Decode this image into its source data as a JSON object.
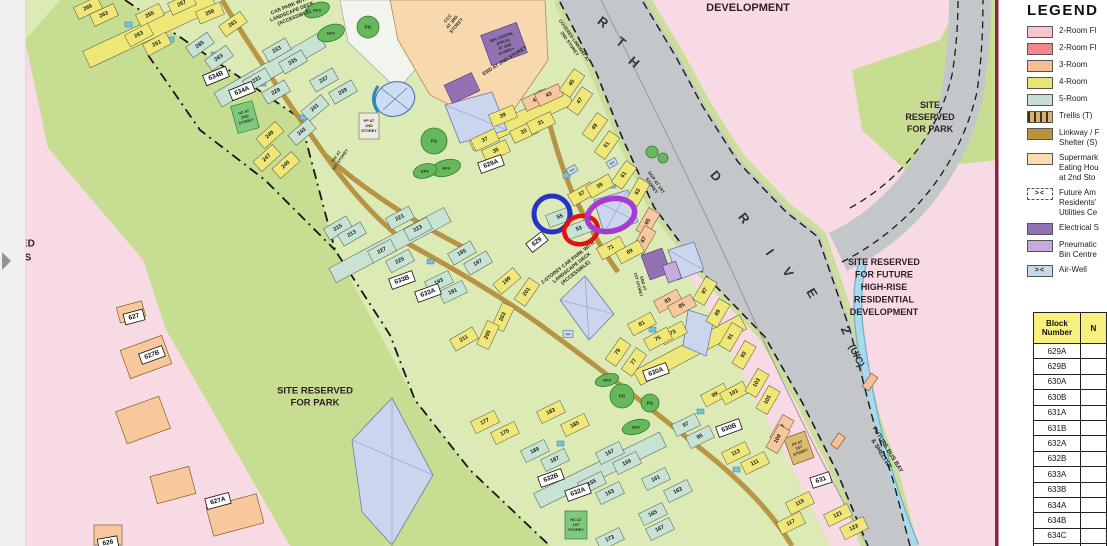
{
  "legend": {
    "title": "LEGEND",
    "items": [
      {
        "label": "2-Room Fl",
        "color": "#F8C5CF",
        "type": "swatch"
      },
      {
        "label": "2-Room Fl",
        "color": "#F2878D",
        "type": "swatch"
      },
      {
        "label": "3-Room",
        "color": "#F2BE92",
        "type": "swatch"
      },
      {
        "label": "4-Room",
        "color": "#E9E476",
        "type": "swatch"
      },
      {
        "label": "5-Room",
        "color": "#C3E0D0",
        "type": "swatch"
      },
      {
        "label": "Trellis (T)",
        "color": "#D9B36A",
        "type": "trellis"
      },
      {
        "label": "Linkway / F\nShelter (S)",
        "color": "#BA9439",
        "type": "swatch"
      },
      {
        "label": "Supermark\nEating Hou\nat 2nd Sto",
        "color": "#FBDCB2",
        "type": "swatch"
      },
      {
        "label": "Future Am\nResidents'\nUtilities Ce",
        "color": "#FFFFFF",
        "type": "bracket",
        "symbol": "><",
        "dashed": true
      },
      {
        "label": "Electrical S",
        "color": "#9271B5",
        "type": "swatch"
      },
      {
        "label": "Pneumatic\nBin Centre",
        "color": "#C4ABDB",
        "type": "swatch"
      },
      {
        "label": "Air-Well",
        "color": "#C5D9EE",
        "type": "bracket",
        "symbol": "><",
        "dashed": false
      }
    ]
  },
  "block_table": {
    "col1_header": "Block\nNumber",
    "col2_header": "N",
    "rows": [
      "629A",
      "629B",
      "630A",
      "630B",
      "631A",
      "631B",
      "632A",
      "632B",
      "633A",
      "633B",
      "634A",
      "634B",
      "634C",
      "635A"
    ]
  },
  "map": {
    "colors": {
      "y": "#EFE878",
      "t": "#C7E3D3",
      "o": "#F6C89C"
    },
    "site_labels": [
      [
        "DEVELOPMENT",
        748,
        8,
        11,
        12
      ],
      [
        "SITE\nRESERVED\nFOR PARK",
        930,
        117,
        9,
        12
      ],
      [
        "SITE RESERVED\nFOR FUTURE\nHIGH-RISE\nRESIDENTIAL\nDEVELOPMENT",
        884,
        287,
        9,
        12.5
      ],
      [
        "SITE RESERVED\nFOR PARK",
        315,
        397,
        9.5,
        12
      ],
      [
        "RVED\nOLS",
        21,
        251,
        10,
        14
      ]
    ],
    "road_labels": [
      [
        "R",
        603,
        22,
        38,
        13
      ],
      [
        "T",
        621,
        42,
        40,
        13
      ],
      [
        "H",
        634,
        62,
        42,
        13
      ],
      [
        "D",
        716,
        176,
        50,
        13
      ],
      [
        "R",
        744,
        218,
        52,
        13
      ],
      [
        "I",
        770,
        252,
        55,
        13
      ],
      [
        "V",
        788,
        272,
        58,
        13
      ],
      [
        "E",
        812,
        293,
        60,
        13
      ],
      [
        "2",
        846,
        330,
        64,
        13
      ],
      [
        "(U/C)",
        856,
        356,
        64,
        10
      ]
    ],
    "block_labels": [
      [
        "634B",
        216,
        76,
        -22
      ],
      [
        "634A",
        242,
        91,
        -22
      ],
      [
        "629A",
        491,
        164,
        -20
      ],
      [
        "629",
        537,
        242,
        -38
      ],
      [
        "633B",
        402,
        280,
        -20
      ],
      [
        "633A",
        428,
        293,
        -20
      ],
      [
        "630A",
        656,
        372,
        -20
      ],
      [
        "630B",
        729,
        428,
        -20
      ],
      [
        "631",
        821,
        480,
        -18
      ],
      [
        "632B",
        551,
        478,
        -20
      ],
      [
        "632A",
        578,
        492,
        -20
      ],
      [
        "627B",
        152,
        355,
        -20
      ],
      [
        "627A",
        218,
        501,
        -15
      ],
      [
        "627",
        134,
        317,
        -15
      ],
      [
        "626",
        108,
        543,
        -10
      ]
    ],
    "facility_labels": [
      [
        "CCC\nAT 3RD\nSTOREY",
        452,
        22,
        -50,
        4.5
      ],
      [
        "EBD AT 2ND STOREY",
        505,
        61,
        -32,
        5
      ],
      [
        "EBD AT\n1ST STOREY",
        641,
        284,
        75,
        4
      ],
      [
        "DGP AT 1ST\nSTOREY",
        654,
        184,
        55,
        4.5
      ],
      [
        "COVERED LINKWAY AT\n2ND STOREY",
        572,
        42,
        55,
        4.5
      ],
      [
        "2-STOREY CAR PARK WITH\nLANDSCAPE DECK\n(ACCESSIBLE)",
        572,
        268,
        -38,
        5
      ],
      [
        "CAR PARK WITH\nLANDSCAPE DECK\n(ACCESSIBLE)",
        292,
        12,
        -22,
        5
      ],
      [
        "FUTURE BUS BAY\n& SHELTER",
        884,
        452,
        58,
        6
      ],
      [
        "TAF AT\n1ST STOREY",
        338,
        158,
        -55,
        4
      ],
      [
        "BIN CENTRE\n(PRCS)\nAT 2ND\nSTOREY",
        504,
        44,
        -20,
        4
      ],
      [
        "HC AT\n2ND\nSTOREY",
        245,
        117,
        -15,
        3.8
      ],
      [
        "HC AT\n1ST\nSTOREY",
        576,
        525,
        0,
        3.8
      ],
      [
        "PP AT\n1ST\nSTOREY",
        799,
        448,
        -20,
        3.8
      ],
      [
        "PP AT\n2ND\nSTOREY",
        369,
        126,
        0,
        3.8
      ],
      [
        "PG",
        368,
        27,
        0,
        4.5
      ],
      [
        "AFS",
        317,
        10,
        0,
        4
      ],
      [
        "EFS",
        331,
        33,
        0,
        4
      ],
      [
        "PG",
        434,
        141,
        0,
        4.5
      ],
      [
        "AFS",
        446,
        168,
        0,
        4
      ],
      [
        "EFS",
        425,
        171,
        0,
        4
      ],
      [
        "AFS",
        607,
        380,
        0,
        4
      ],
      [
        "PG",
        622,
        396,
        0,
        4.5
      ],
      [
        "PG",
        650,
        403,
        0,
        4.5
      ],
      [
        "EFS",
        636,
        427,
        0,
        4
      ],
      [
        "><",
        572,
        170,
        -30,
        4
      ],
      [
        "><",
        612,
        163,
        -30,
        4
      ],
      [
        "><",
        568,
        334,
        0,
        4
      ]
    ],
    "unit_labels": [
      [
        "257",
        182,
        4,
        -25,
        "y"
      ],
      [
        "265",
        88,
        8,
        -25,
        "y"
      ],
      [
        "263",
        104,
        15,
        -25,
        "y"
      ],
      [
        "255",
        150,
        15,
        -27,
        "y"
      ],
      [
        "253",
        139,
        35,
        -28,
        "y"
      ],
      [
        "251",
        157,
        44,
        -28,
        "y"
      ],
      [
        "259",
        210,
        13,
        -22,
        "y"
      ],
      [
        "261",
        233,
        24,
        -35,
        "y"
      ],
      [
        "265",
        200,
        45,
        -35,
        "t"
      ],
      [
        "263",
        219,
        58,
        -35,
        "t"
      ],
      [
        "233",
        277,
        50,
        -30,
        "t"
      ],
      [
        "235",
        293,
        62,
        -30,
        "t"
      ],
      [
        "231",
        257,
        80,
        -30,
        "t"
      ],
      [
        "229",
        276,
        92,
        -30,
        "t"
      ],
      [
        "237",
        324,
        80,
        -30,
        "t"
      ],
      [
        "239",
        343,
        92,
        -30,
        "t"
      ],
      [
        "241",
        315,
        108,
        -40,
        "t"
      ],
      [
        "243",
        302,
        132,
        -40,
        "t"
      ],
      [
        "249",
        270,
        135,
        -42,
        "y"
      ],
      [
        "247",
        267,
        158,
        -42,
        "y"
      ],
      [
        "245",
        286,
        165,
        -42,
        "y"
      ],
      [
        "215",
        338,
        228,
        -30,
        "t"
      ],
      [
        "213",
        352,
        234,
        -30,
        "t"
      ],
      [
        "221",
        400,
        218,
        -28,
        "t"
      ],
      [
        "223",
        418,
        229,
        -28,
        "t"
      ],
      [
        "227",
        382,
        251,
        -28,
        "t"
      ],
      [
        "225",
        400,
        261,
        -28,
        "t"
      ],
      [
        "195",
        462,
        253,
        -30,
        "t"
      ],
      [
        "197",
        478,
        263,
        -30,
        "t"
      ],
      [
        "193",
        439,
        282,
        -26,
        "t"
      ],
      [
        "191",
        453,
        292,
        -26,
        "t"
      ],
      [
        "199",
        507,
        281,
        -40,
        "y"
      ],
      [
        "201",
        527,
        292,
        -55,
        "y"
      ],
      [
        "203",
        503,
        317,
        -65,
        "y"
      ],
      [
        "205",
        488,
        335,
        -65,
        "y"
      ],
      [
        "211",
        464,
        339,
        -30,
        "y"
      ],
      [
        "39",
        503,
        116,
        -22,
        "y"
      ],
      [
        "37",
        485,
        140,
        -25,
        "y"
      ],
      [
        "35",
        496,
        151,
        -25,
        "y"
      ],
      [
        "33",
        524,
        132,
        -25,
        "y"
      ],
      [
        "31",
        541,
        123,
        -25,
        "y"
      ],
      [
        "41",
        536,
        100,
        -25,
        "o"
      ],
      [
        "43",
        549,
        95,
        -25,
        "o"
      ],
      [
        "45",
        572,
        83,
        -55,
        "y"
      ],
      [
        "47",
        580,
        101,
        -55,
        "y"
      ],
      [
        "49",
        595,
        127,
        -55,
        "y"
      ],
      [
        "51",
        607,
        145,
        -55,
        "y"
      ],
      [
        "57",
        582,
        194,
        -30,
        "y"
      ],
      [
        "59",
        600,
        186,
        -30,
        "y"
      ],
      [
        "61",
        624,
        175,
        -55,
        "y"
      ],
      [
        "63",
        638,
        192,
        -60,
        "y"
      ],
      [
        "65",
        648,
        222,
        -60,
        "o"
      ],
      [
        "67",
        644,
        240,
        -60,
        "o"
      ],
      [
        "55",
        560,
        217,
        -20,
        "t"
      ],
      [
        "53",
        579,
        229,
        -20,
        "t"
      ],
      [
        "71",
        611,
        248,
        -28,
        "y"
      ],
      [
        "69",
        630,
        252,
        -28,
        "y"
      ],
      [
        "81",
        642,
        324,
        -28,
        "y"
      ],
      [
        "83",
        668,
        301,
        -28,
        "o"
      ],
      [
        "85",
        682,
        306,
        -28,
        "o"
      ],
      [
        "87",
        705,
        291,
        -60,
        "y"
      ],
      [
        "89",
        718,
        313,
        -60,
        "y"
      ],
      [
        "91",
        731,
        337,
        -60,
        "y"
      ],
      [
        "93",
        744,
        355,
        -60,
        "y"
      ],
      [
        "73",
        673,
        333,
        -28,
        "y"
      ],
      [
        "75",
        658,
        339,
        -28,
        "y"
      ],
      [
        "79",
        618,
        352,
        -55,
        "y"
      ],
      [
        "77",
        634,
        362,
        -55,
        "y"
      ],
      [
        "99",
        715,
        395,
        -28,
        "y"
      ],
      [
        "101",
        734,
        393,
        -28,
        "y"
      ],
      [
        "103",
        757,
        383,
        -60,
        "y"
      ],
      [
        "105",
        768,
        400,
        -60,
        "y"
      ],
      [
        "107",
        782,
        429,
        -60,
        "o"
      ],
      [
        "109",
        778,
        439,
        -60,
        "o"
      ],
      [
        "97",
        686,
        425,
        -26,
        "t"
      ],
      [
        "95",
        700,
        437,
        -26,
        "t"
      ],
      [
        "113",
        736,
        453,
        -26,
        "y"
      ],
      [
        "111",
        755,
        463,
        -26,
        "y"
      ],
      [
        "119",
        800,
        503,
        -26,
        "y"
      ],
      [
        "117",
        791,
        523,
        -26,
        "y"
      ],
      [
        "121",
        838,
        515,
        -26,
        "y"
      ],
      [
        "123",
        854,
        528,
        -26,
        "y"
      ],
      [
        "177",
        485,
        422,
        -26,
        "y"
      ],
      [
        "175",
        505,
        433,
        -26,
        "y"
      ],
      [
        "183",
        551,
        412,
        -26,
        "y"
      ],
      [
        "185",
        575,
        425,
        -26,
        "y"
      ],
      [
        "189",
        535,
        451,
        -26,
        "t"
      ],
      [
        "187",
        555,
        460,
        -26,
        "t"
      ],
      [
        "157",
        610,
        453,
        -26,
        "t"
      ],
      [
        "159",
        627,
        463,
        -26,
        "t"
      ],
      [
        "155",
        592,
        483,
        -26,
        "t"
      ],
      [
        "153",
        610,
        493,
        -26,
        "t"
      ],
      [
        "161",
        656,
        479,
        -26,
        "t"
      ],
      [
        "163",
        678,
        491,
        -26,
        "t"
      ],
      [
        "165",
        653,
        514,
        -26,
        "t"
      ],
      [
        "167",
        660,
        529,
        -26,
        "t"
      ],
      [
        "173",
        610,
        539,
        -26,
        "t"
      ]
    ],
    "annotations": [
      {
        "color": "#2633C4",
        "cx": 552,
        "cy": 214,
        "rx": 18,
        "ry": 18,
        "w": 5,
        "rot": 0
      },
      {
        "color": "#E01312",
        "cx": 581,
        "cy": 230,
        "rx": 17,
        "ry": 14,
        "w": 4.5,
        "rot": -15
      },
      {
        "color": "#A63BD4",
        "cx": 611,
        "cy": 215,
        "rx": 24,
        "ry": 16,
        "w": 5.5,
        "rot": -14
      }
    ]
  }
}
